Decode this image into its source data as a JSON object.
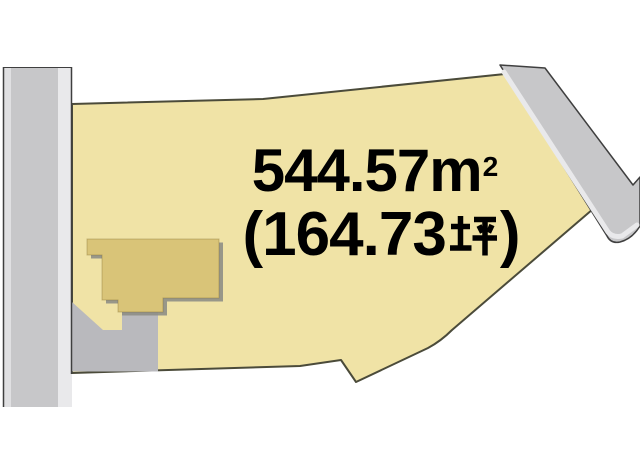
{
  "diagram": {
    "type": "land-plot-diagram",
    "area_m2_text": "544.57㎡",
    "area_m2": {
      "value": "544.57",
      "unit_base": "m",
      "unit_exponent": "2"
    },
    "area_tsubo_text": "(164.73坪)",
    "area_tsubo": {
      "prefix": "(164.73",
      "unit_kanji": "坪",
      "suffix": ")"
    },
    "colors": {
      "background": "#ffffff",
      "parcel_fill": "#f0e3a6",
      "parcel_outline": "#4b4b3a",
      "building_fill": "#d9c478",
      "building_shadow": "#8e8e86",
      "road_fill": "#c7c7c9",
      "road_edge_stripe": "#e9e9eb",
      "road_edge_stripe2": "#e0e0e2",
      "road_outline": "#3f3f3f",
      "driveway_fill": "#b9b9bd",
      "text_color": "#000000"
    }
  }
}
